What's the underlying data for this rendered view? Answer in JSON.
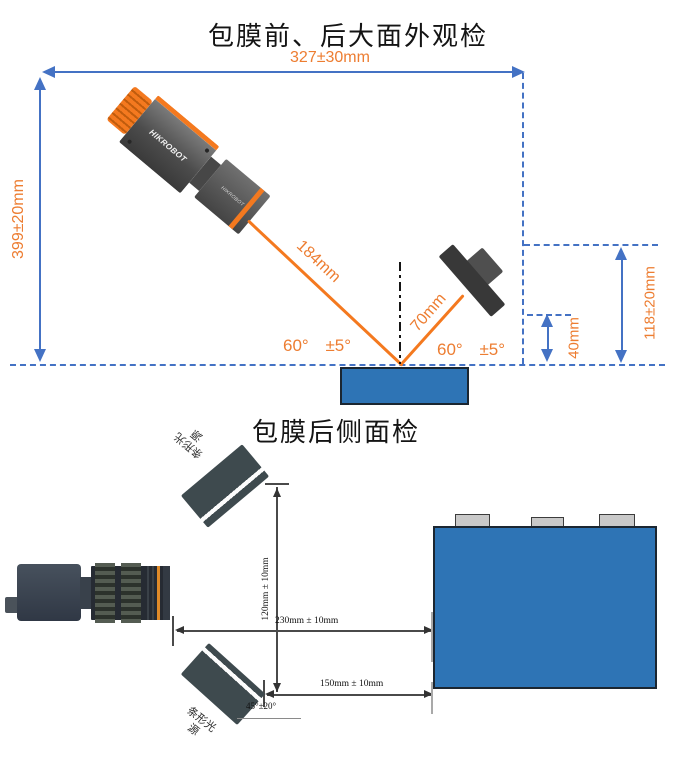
{
  "top_diagram": {
    "title": "包膜前、后大面外观检",
    "width_label": "327±30mm",
    "height_label": "399±20mm",
    "camera_brand": "HIKROBOT",
    "lens_brand": "HIKROBOT",
    "beam_length_label": "184mm",
    "light_distance_label": "70mm",
    "left_angle": "60°",
    "left_angle_tolerance": "±5°",
    "right_angle": "60°",
    "right_angle_tolerance": "±5°",
    "light_height_label": "118±20mm",
    "light_bottom_offset_label": "40mm"
  },
  "bottom_diagram": {
    "title": "包膜后侧面检",
    "vertical_distance_label": "120mm ± 10mm",
    "camera_distance_label": "230mm ± 10mm",
    "light_distance_label": "150mm ± 10mm",
    "light_angle_label": "45°±20°",
    "top_light_label_line1": "条形光",
    "top_light_label_line2": "源",
    "bottom_light_label_line1": "条形光",
    "bottom_light_label_line2": "源"
  },
  "colors": {
    "dimension_blue": "#4472C4",
    "accent_orange": "#ED7D31",
    "beam_orange": "#F4791F",
    "battery_blue": "#2E74B5",
    "bar_light_slate": "#3E4A4E"
  }
}
